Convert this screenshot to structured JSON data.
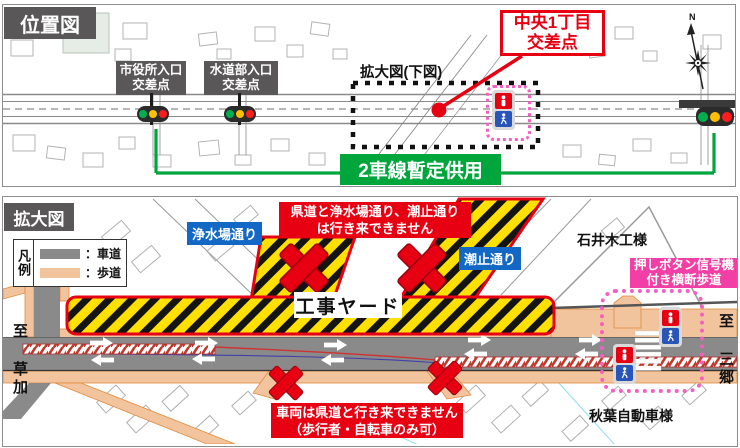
{
  "colors": {
    "accent_red": "#e60012",
    "accent_green": "#00a53c",
    "label_blue": "#1268c4",
    "label_pink": "#f23fa6",
    "label_gray": "#595757",
    "roadway_gray": "#8a8a8a",
    "sidewalk_peach": "#f2c49e",
    "yard_yellow": "#ffe000"
  },
  "location_map": {
    "title": "位置図",
    "compass_n": "N",
    "intersections": [
      {
        "line1": "市役所入口",
        "line2": "交差点"
      },
      {
        "line1": "水道部入口",
        "line2": "交差点"
      }
    ],
    "highlight_intersection": {
      "line1": "中央1丁目",
      "line2": "交差点"
    },
    "enlarged_ref": "拡大図(下図)",
    "provisional_note": "2車線暫定供用"
  },
  "enlarged_map": {
    "title": "拡大図",
    "legend": {
      "caption": "凡例",
      "items": [
        {
          "label": "：車道"
        },
        {
          "label": "：歩道"
        }
      ]
    },
    "streets": {
      "josuijo": "浄水場通り",
      "shiodome": "潮止通り"
    },
    "yard_label": "工事ヤード",
    "banner_top": {
      "line1": "県道と浄水場通り、潮止通り",
      "line2": "は行き来できません"
    },
    "banner_bottom": {
      "line1": "車両は県道と行き来できません",
      "line2": "（歩行者・自転車のみ可）"
    },
    "signal_note": {
      "line1": "押しボタン信号機",
      "line2": "付き横断歩道"
    },
    "companies": {
      "ishii": "石井木工様",
      "akiba": "秋葉自動車様"
    },
    "directions": {
      "left": "至 草加",
      "right": "至 三郷"
    }
  }
}
